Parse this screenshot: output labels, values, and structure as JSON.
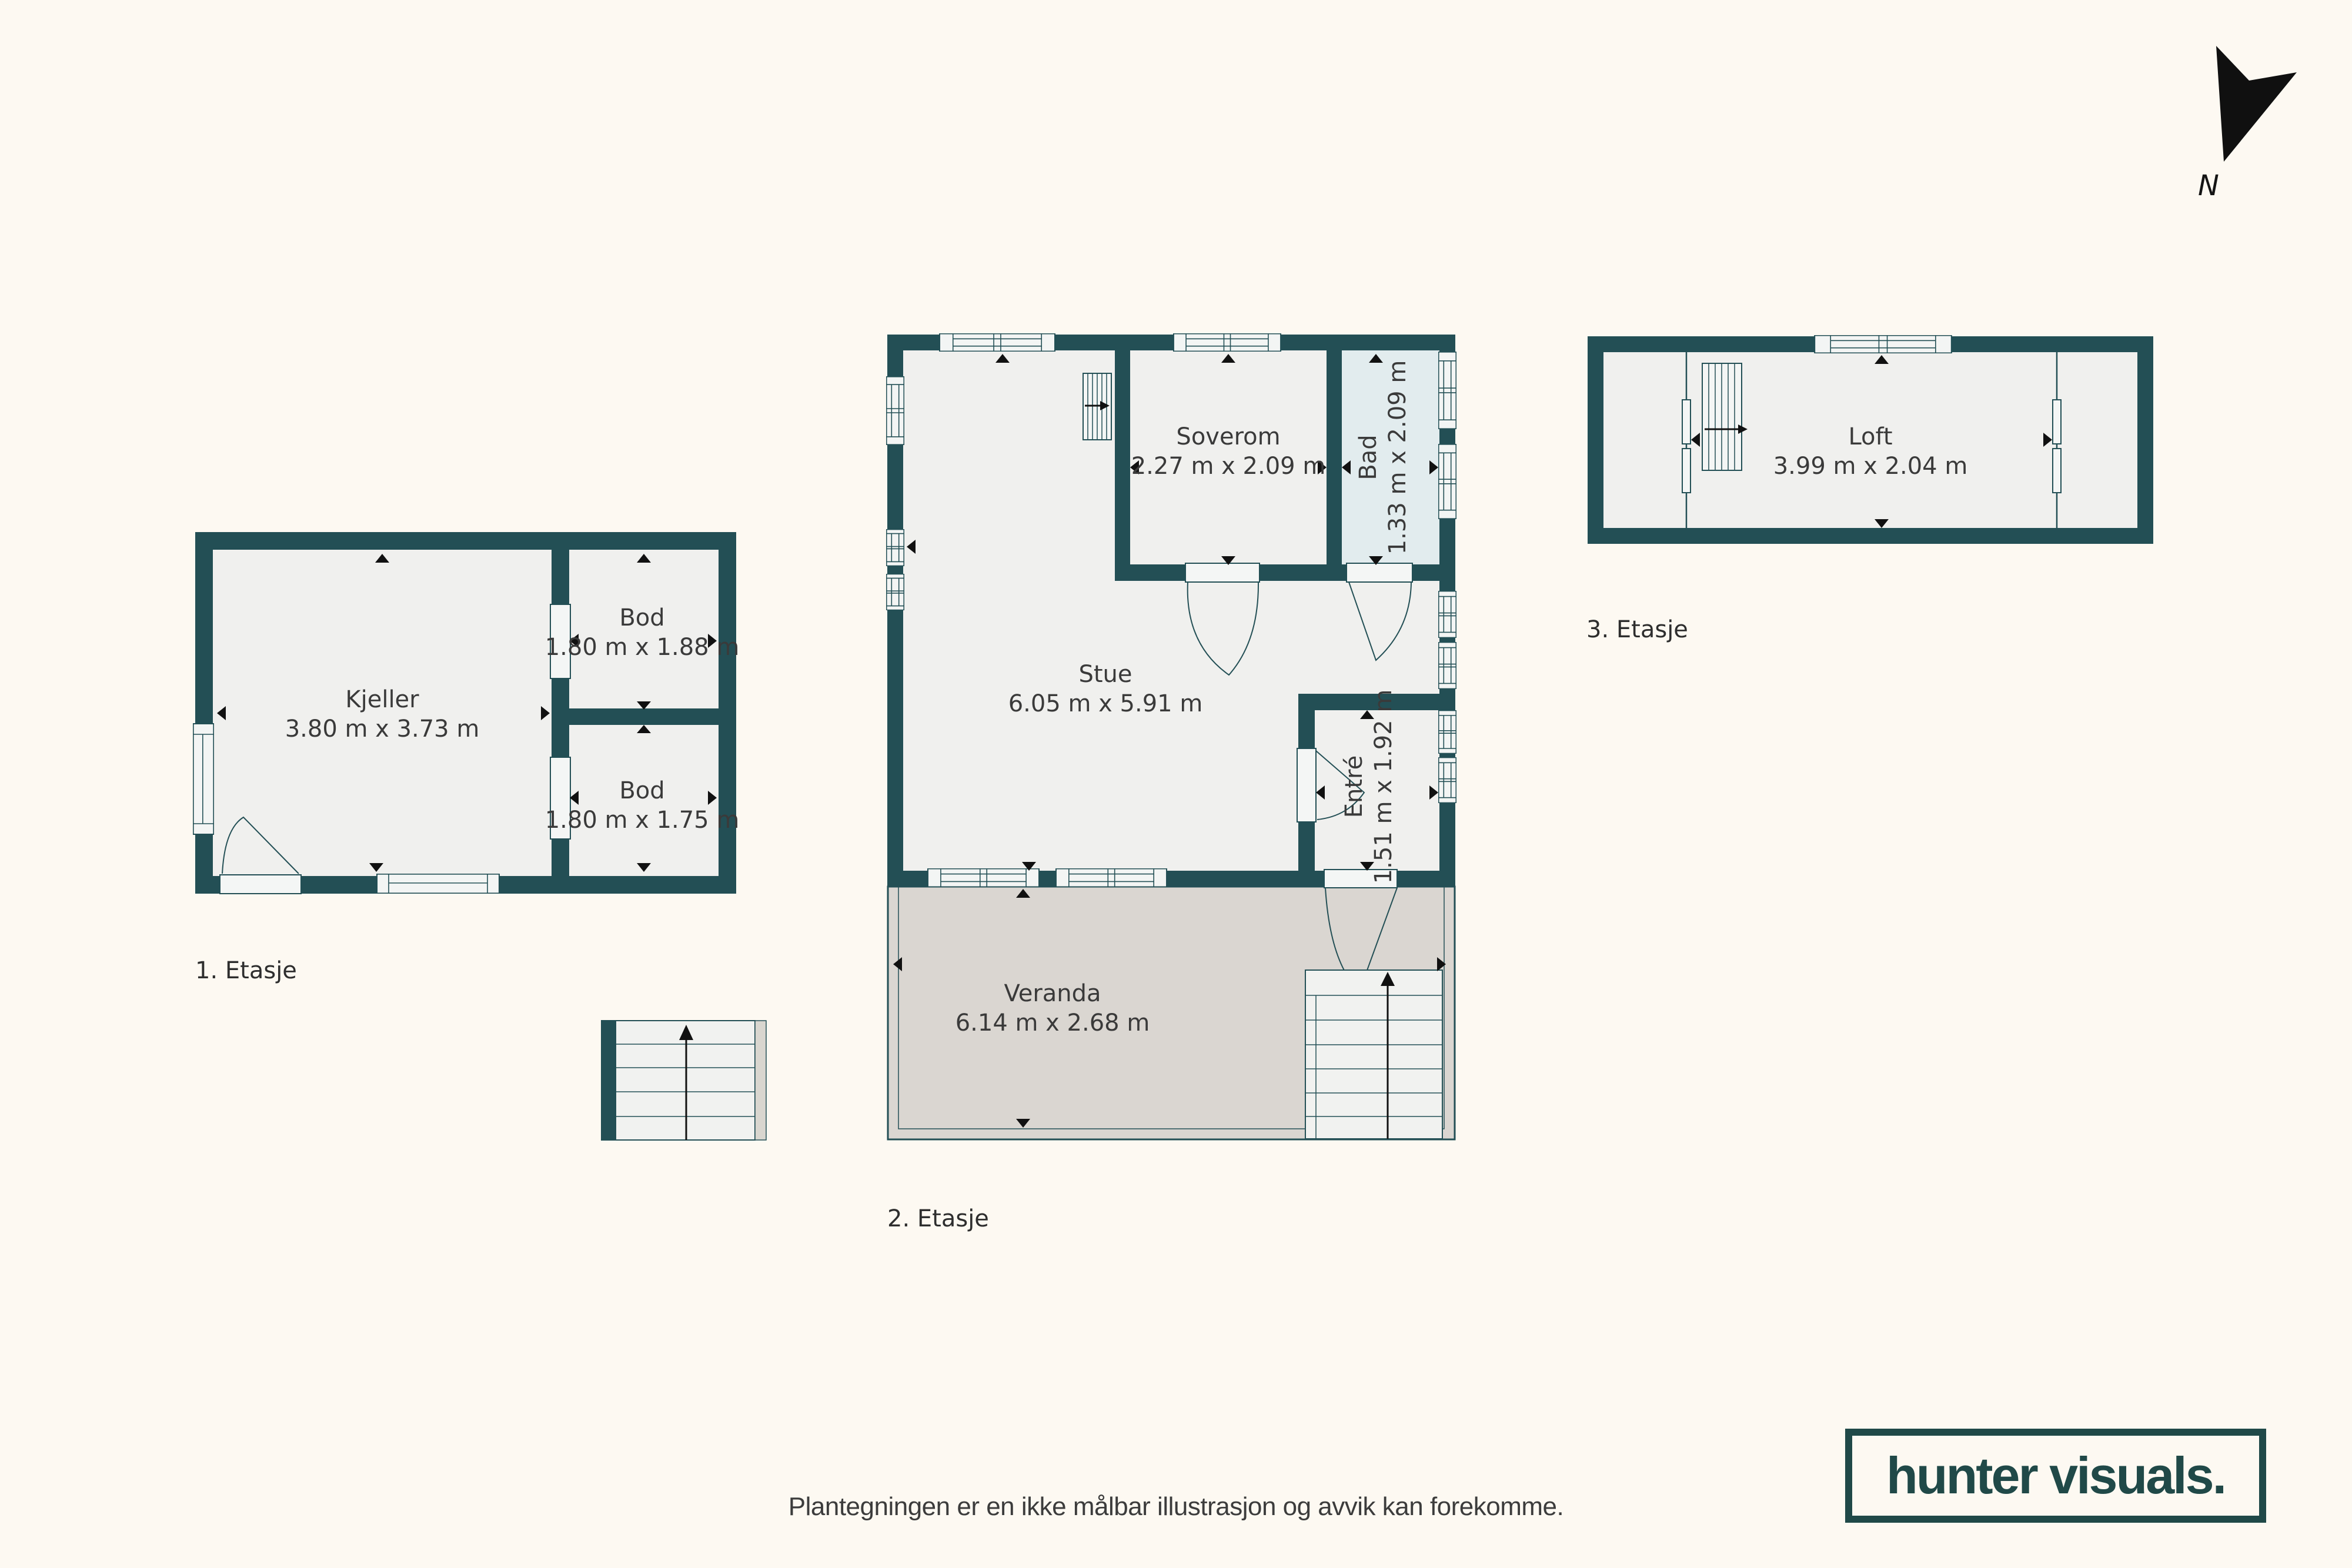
{
  "page": {
    "disclaimer": "Plantegningen er en ikke målbar illustrasjon og avvik kan forekomme."
  },
  "branding": {
    "logo_text": "hunter visuals."
  },
  "compass": {
    "label": "N"
  },
  "colors": {
    "bg": "#fdf9f2",
    "wall": "#234f55",
    "floor": "#f0f0ee",
    "bad": "#e2ecee",
    "verandaf": "#dad6d1",
    "logo": "#204948",
    "ink": "#3a3a3a"
  },
  "floors": [
    {
      "label": "1. Etasje",
      "rooms": [
        {
          "name": "Kjeller",
          "dimensions": "3.80 m x 3.73 m"
        },
        {
          "name": "Bod",
          "dimensions": "1.80 m x 1.88 m"
        },
        {
          "name": "Bod",
          "dimensions": "1.80 m x 1.75 m"
        }
      ]
    },
    {
      "label": "2. Etasje",
      "rooms": [
        {
          "name": "Stue",
          "dimensions": "6.05 m x 5.91 m"
        },
        {
          "name": "Soverom",
          "dimensions": "2.27 m x 2.09 m"
        },
        {
          "name": "Bad",
          "dimensions": "1.33 m x 2.09 m"
        },
        {
          "name": "Entré",
          "dimensions": "1.51 m x 1.92 m"
        },
        {
          "name": "Veranda",
          "dimensions": "6.14 m x 2.68 m"
        }
      ]
    },
    {
      "label": "3. Etasje",
      "rooms": [
        {
          "name": "Loft",
          "dimensions": "3.99 m x 2.04 m"
        }
      ]
    }
  ]
}
